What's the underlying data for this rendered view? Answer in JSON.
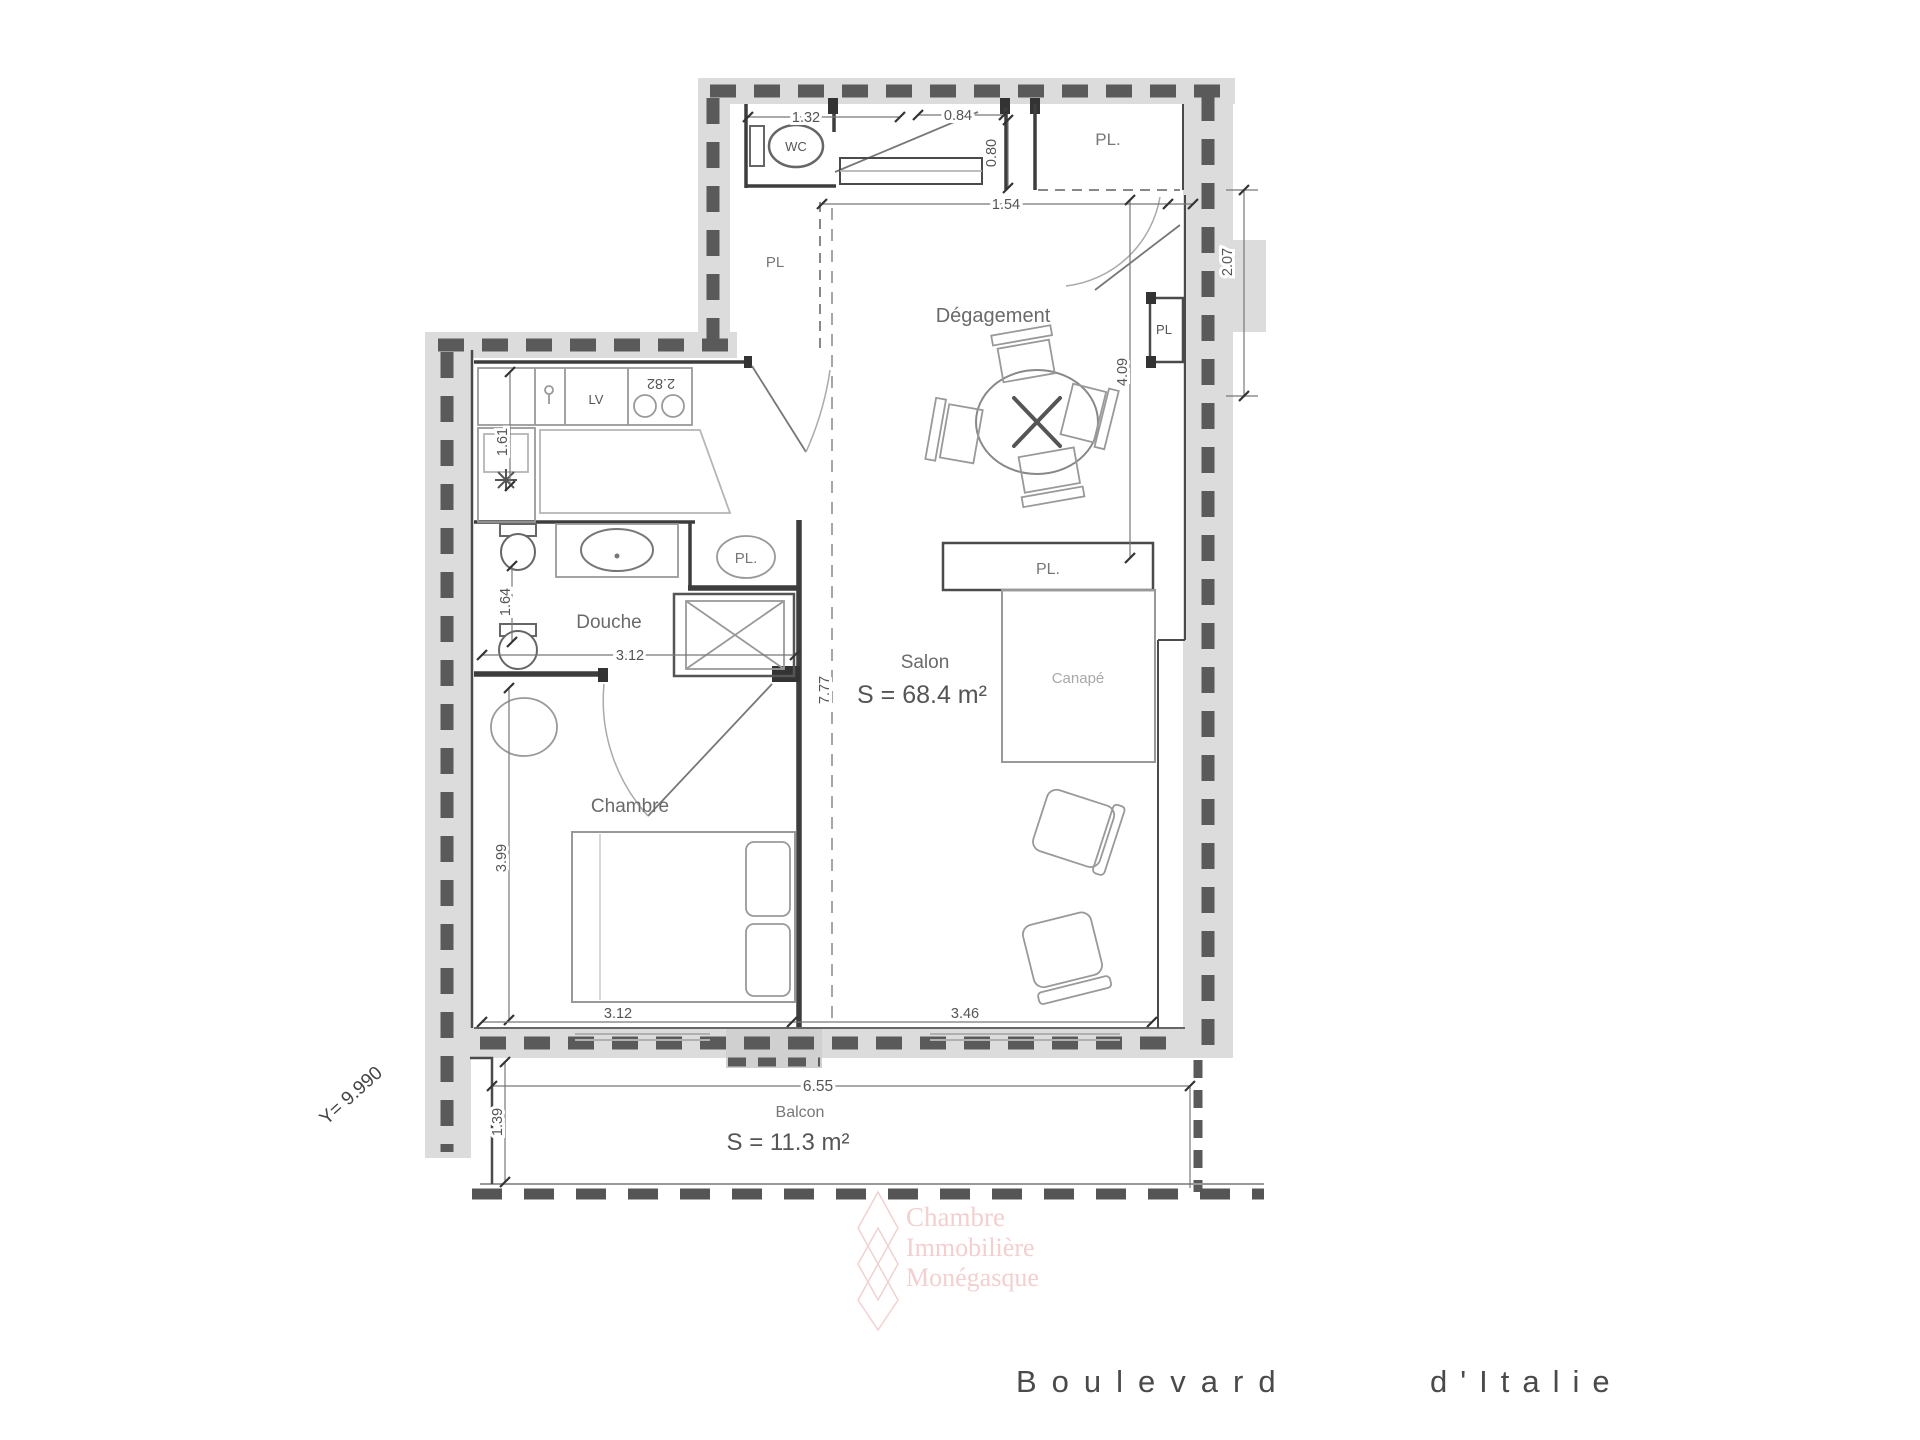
{
  "plan": {
    "rooms": {
      "wc": "WC",
      "pl_top": "PL.",
      "pl_entry": "PL",
      "pl_niche": "PL",
      "degagement": "Dégagement",
      "salon": "Salon",
      "salon_area": "S = 68.4 m²",
      "pl_shelf": "PL.",
      "canape": "Canapé",
      "lv": "LV",
      "douche": "Douche",
      "pl_closet": "PL.",
      "chambre": "Chambre",
      "balcon": "Balcon",
      "balcon_area": "S = 11.3 m²"
    },
    "dimensions": {
      "wc_width": "1.32",
      "entry_door": "0.84",
      "entry_recess": "0.80",
      "hall": "1.54",
      "niche_h": "2.07",
      "degagement_h": "4.09",
      "kitchen_w": "2.82",
      "kitchen_h": "1.61",
      "douche_h": "1.64",
      "douche_w": "3.12",
      "salon_h": "7.77",
      "chambre_h": "3.99",
      "chambre_w": "3.12",
      "salon_w": "3.46",
      "balcon_w": "6.55",
      "balcon_d": "1.39",
      "y_coord": "Y= 9.990"
    },
    "watermark": [
      "Chambre",
      "Immobilière",
      "Monégasque"
    ],
    "street": {
      "word1": "Boulevard",
      "word2": "d'Italie"
    }
  }
}
